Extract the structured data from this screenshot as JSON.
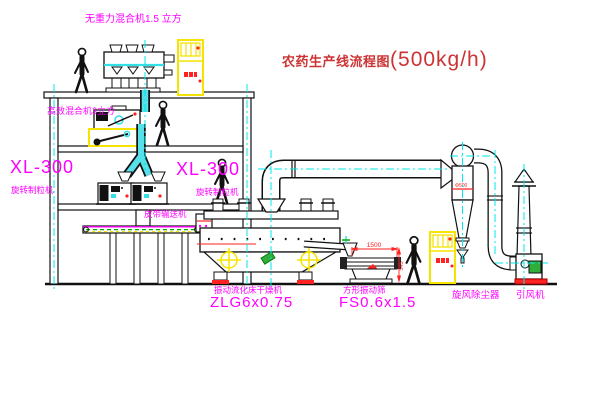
{
  "diagram": {
    "kind": "cad-process-flow-drawing",
    "title": {
      "name": "农药生产线流程图",
      "capacity": "(500kg/h)"
    },
    "labels": {
      "top_mixer": "无重力混合机1.5 立方",
      "floor2_mixer": "高效混合机3立方",
      "granulator_left_model": "XL-300",
      "granulator_left_name": "旋转制粒机",
      "granulator_center_model": "XL-300",
      "granulator_center_name": "旋转制粒机",
      "belt_conveyor": "皮带输送机",
      "dryer_name": "振动流化床干燥机",
      "dryer_model": "ZLG6x0.75",
      "sieve_name": "方形振动筛",
      "sieve_model": "FS0.6x1.5",
      "cyclone": "旋风除尘器",
      "fan": "引风机"
    },
    "dimensions": {
      "sieve_length": "1500",
      "sieve_height": "545",
      "cyclone_diameter": "Φ500"
    },
    "colors": {
      "label_magenta": "#ff00ff",
      "title_red": "#cc3333",
      "centerline_cyan": "#00e8e8",
      "pipe_cyan": "#55e0ea",
      "cabinet_yellow": "#f5e400",
      "alert_red": "#ff2222",
      "motor_green": "#2fae3a",
      "line_black": "#111111"
    }
  }
}
